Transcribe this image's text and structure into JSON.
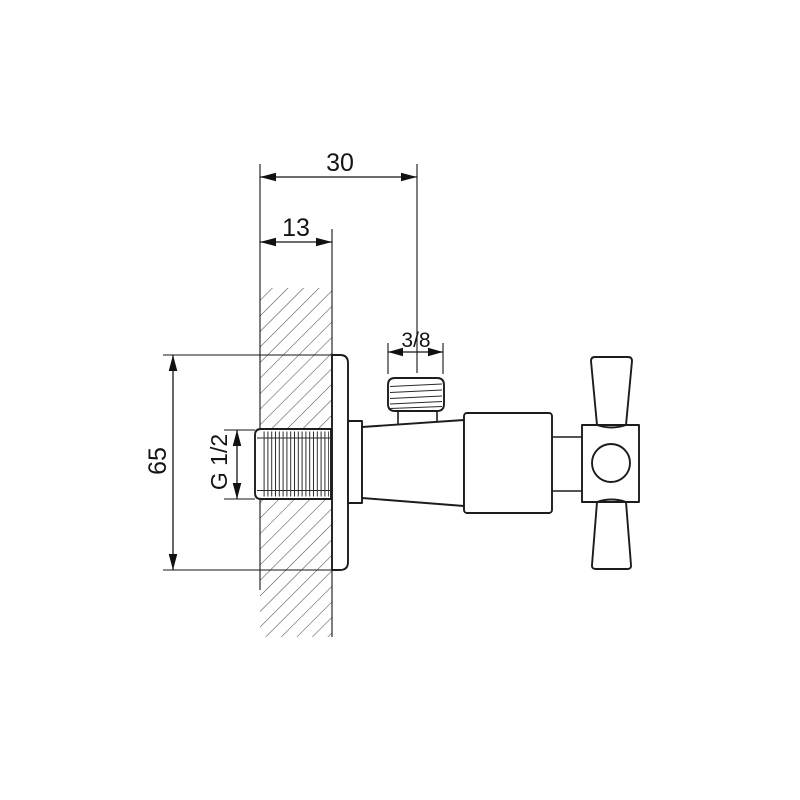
{
  "drawing": {
    "kind": "angle-valve-dimension-drawing",
    "labels": {
      "total_depth": "30",
      "wall_thickness": "13",
      "outlet_thread": "3/8",
      "plate_height": "65",
      "inlet_thread": "G 1/2"
    },
    "colors": {
      "outline": "#1c1c1c",
      "dimension": "#151515",
      "hatch": "#4f4f4f",
      "background": "#ffffff"
    }
  }
}
